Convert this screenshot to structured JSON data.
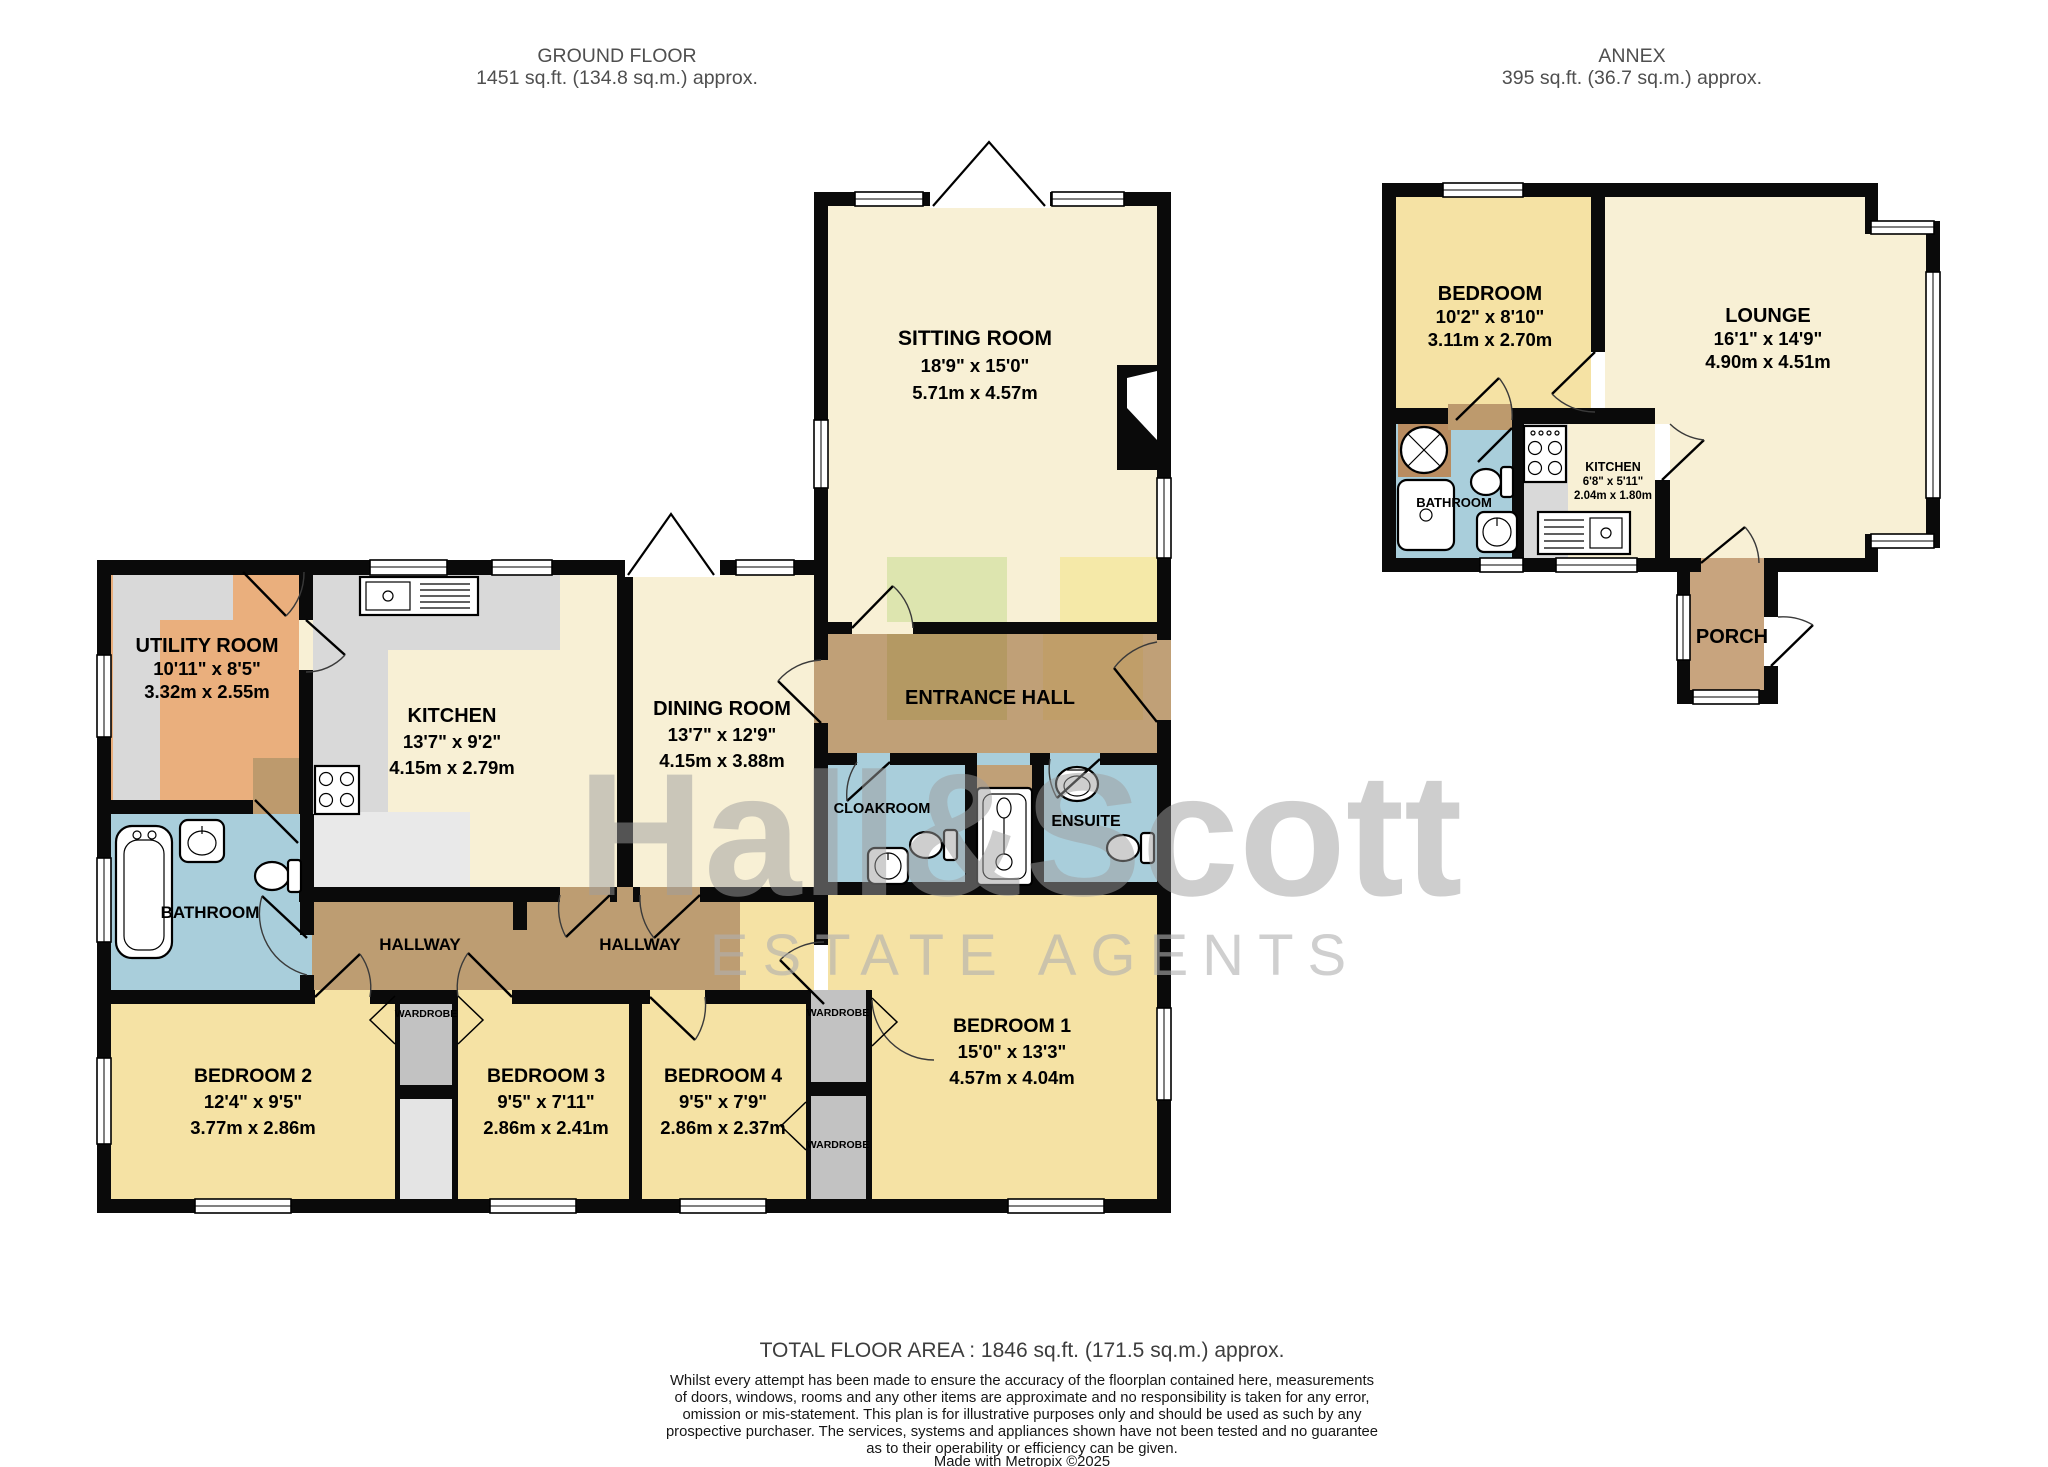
{
  "page": {
    "ground_floor_title": "GROUND FLOOR",
    "ground_floor_area": "1451 sq.ft. (134.8 sq.m.) approx.",
    "annex_title": "ANNEX",
    "annex_area": "395 sq.ft. (36.7 sq.m.) approx."
  },
  "watermark": {
    "name": "Hall&Scott",
    "tagline": "ESTATE AGENTS"
  },
  "main": {
    "sitting_room": {
      "name": "SITTING ROOM",
      "imperial": "18'9\"  x 15'0\"",
      "metric": "5.71m  x 4.57m"
    },
    "entrance_hall": {
      "name": "ENTRANCE HALL"
    },
    "utility_room": {
      "name": "UTILITY ROOM",
      "imperial": "10'11\"  x 8'5\"",
      "metric": "3.32m  x 2.55m"
    },
    "kitchen": {
      "name": "KITCHEN",
      "imperial": "13'7\"  x 9'2\"",
      "metric": "4.15m  x 2.79m"
    },
    "dining_room": {
      "name": "DINING ROOM",
      "imperial": "13'7\"  x 12'9\"",
      "metric": "4.15m  x 3.88m"
    },
    "cloakroom": {
      "name": "CLOAKROOM"
    },
    "ensuite": {
      "name": "ENSUITE"
    },
    "bathroom": {
      "name": "BATHROOM"
    },
    "hallway_west": {
      "name": "HALLWAY"
    },
    "hallway_east": {
      "name": "HALLWAY"
    },
    "bedroom_1": {
      "name": "BEDROOM 1",
      "imperial": "15'0\"  x 13'3\"",
      "metric": "4.57m  x 4.04m"
    },
    "bedroom_2": {
      "name": "BEDROOM 2",
      "imperial": "12'4\"  x 9'5\"",
      "metric": "3.77m  x 2.86m"
    },
    "bedroom_3": {
      "name": "BEDROOM 3",
      "imperial": "9'5\"  x 7'11\"",
      "metric": "2.86m  x 2.41m"
    },
    "bedroom_4": {
      "name": "BEDROOM 4",
      "imperial": "9'5\"  x 7'9\"",
      "metric": "2.86m  x 2.37m"
    },
    "wardrobe_label": "WARDROBE"
  },
  "annex": {
    "bedroom": {
      "name": "BEDROOM",
      "imperial": "10'2\"  x 8'10\"",
      "metric": "3.11m  x 2.70m"
    },
    "lounge": {
      "name": "LOUNGE",
      "imperial": "16'1\"  x 14'9\"",
      "metric": "4.90m  x 4.51m"
    },
    "kitchen": {
      "name": "KITCHEN",
      "imperial": "6'8\"  x 5'11\"",
      "metric": "2.04m  x 1.80m"
    },
    "bathroom": {
      "name": "BATHROOM"
    },
    "porch": {
      "name": "PORCH"
    }
  },
  "footer": {
    "total_area": "TOTAL FLOOR AREA : 1846 sq.ft. (171.5 sq.m.) approx.",
    "disclaimer_line1": "Whilst every attempt has been made to ensure the accuracy of the floorplan contained here, measurements",
    "disclaimer_line2": "of doors, windows, rooms and any other items are approximate and no responsibility is taken for any error,",
    "disclaimer_line3": "omission or mis-statement. This plan is for illustrative purposes only and should be used as such by any",
    "disclaimer_line4": "prospective purchaser. The services, systems and appliances shown have not been tested and no guarantee",
    "disclaimer_line5": "as to their operability or efficiency can be given.",
    "credit": "Made with Metropix ©2025"
  },
  "colors": {
    "wall": "#0a0a0a",
    "cream_room": "#f8f0d5",
    "yellow_bedroom": "#f5e2a4",
    "orange_utility": "#eaaf7d",
    "blue_bathroom": "#a9cedb",
    "brown_hallway": "#bd9d72",
    "brown_entrance": "#c0a077",
    "brown_porch": "#c8a47e",
    "gray_counter": "#d9d9d9",
    "gray_wardrobe": "#c2c2c2",
    "watermark_gray": "#9e9e9e"
  }
}
